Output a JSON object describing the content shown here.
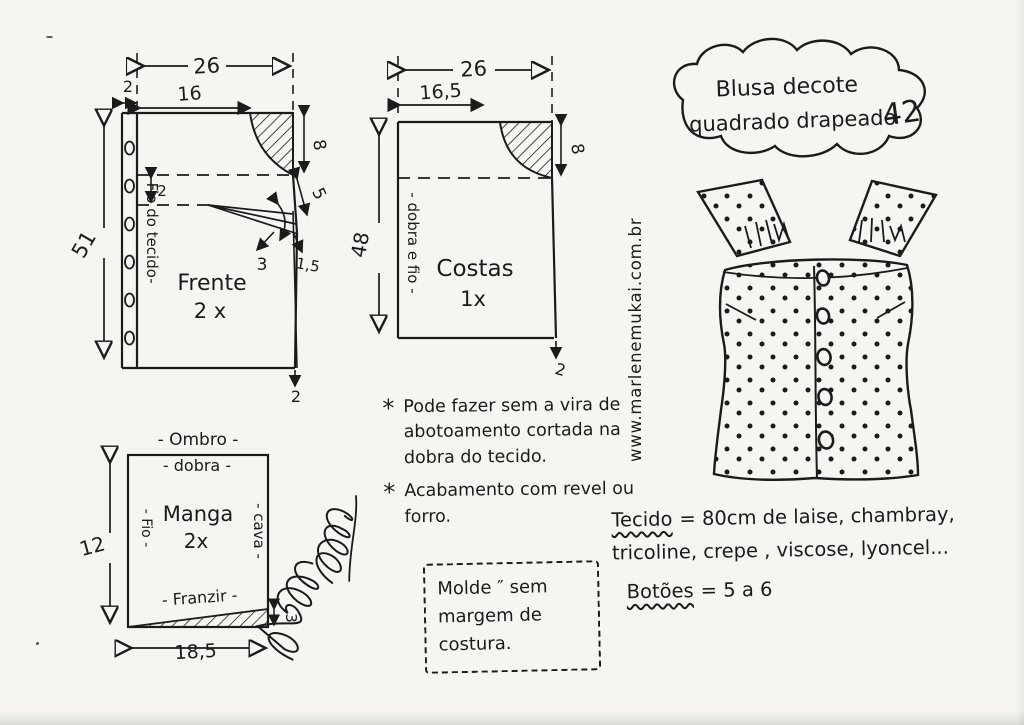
{
  "title_cloud": {
    "line1": "Blusa decote",
    "line2": "quadrado drapeado",
    "size": "42"
  },
  "website": "www.marlenemukai.com.br",
  "signature": "Marlene Mukai",
  "pieces": {
    "frente": {
      "label_line1": "Frente",
      "label_line2": "2 x",
      "grain_label": "- Fio do tecido-",
      "width_total": "26",
      "width_top": "16",
      "band_width": "2",
      "height": "51",
      "neck_depth": "8",
      "neck_slant": "5",
      "fold_gap": "2",
      "dart_width": "3",
      "dart_offset": "1,5",
      "hem_drop": "2"
    },
    "costas": {
      "label_line1": "Costas",
      "label_line2": "1x",
      "fold_label": "- dobra e fio -",
      "width_total": "26",
      "width_top": "16,5",
      "height": "48",
      "neck_depth": "8",
      "hem_drop": "2"
    },
    "manga": {
      "label_line1": "Manga",
      "label_line2": "2x",
      "shoulder_label": "- Ombro -",
      "fold_label": "- dobra -",
      "grain_label": "- Fio -",
      "armhole_label": "- cava -",
      "gather_label": "- Franzir -",
      "height": "12",
      "width": "18,5",
      "wedge_height": "3"
    }
  },
  "notes": [
    {
      "bullet": "*",
      "text": "Pode fazer sem a vira de abotoamento cortada na dobra do tecido."
    },
    {
      "bullet": "*",
      "text": "Acabamento com revel ou forro."
    }
  ],
  "molde_note": {
    "line1": "Molde ″ sem",
    "line2": "margem de",
    "line3": "costura."
  },
  "materials": {
    "fabric_label": "Tecido",
    "fabric_rest1": "= 80cm de laise, chambray,",
    "fabric_rest2": "tricoline, crepe , viscose, lyoncel...",
    "buttons_label": "Botões",
    "buttons_rest": "= 5 a 6"
  }
}
